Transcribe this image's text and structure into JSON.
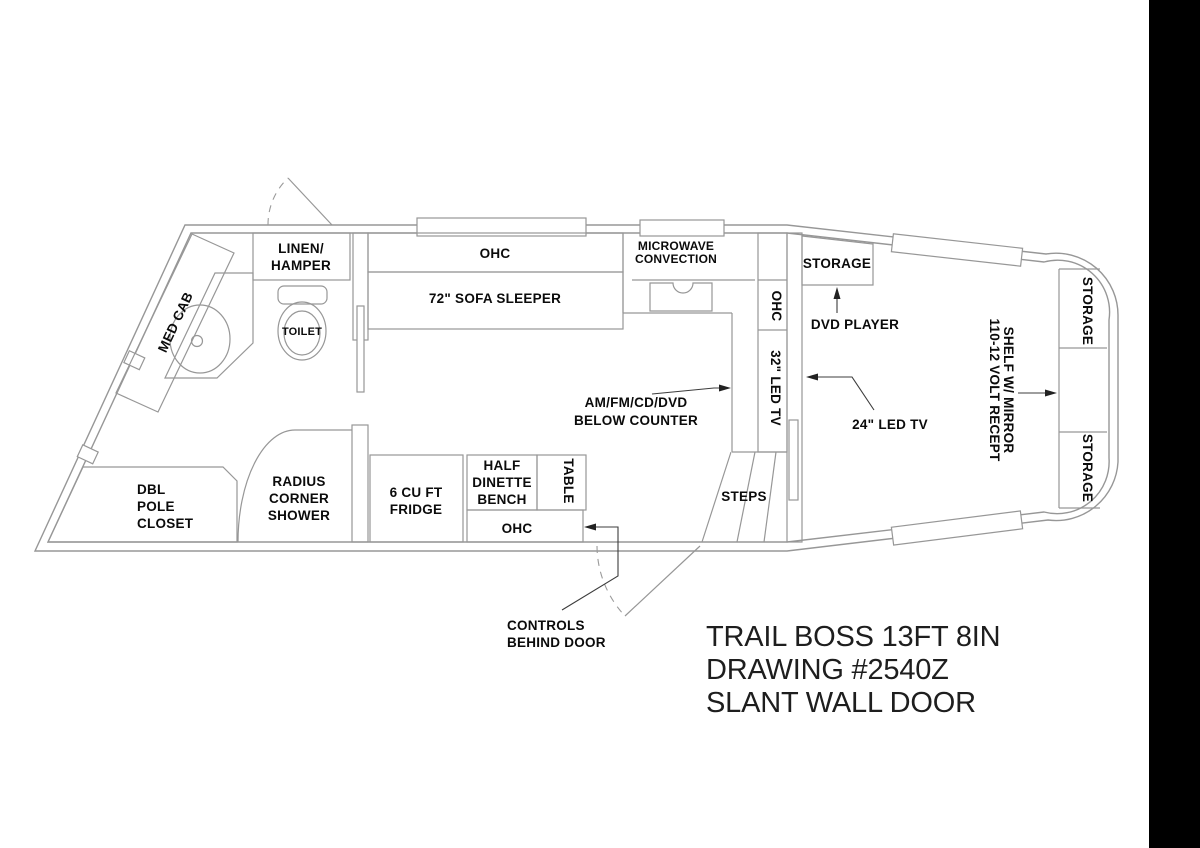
{
  "drawing": {
    "title_lines": [
      "TRAIL BOSS 13FT 8IN",
      "DRAWING #2540Z",
      "SLANT WALL DOOR"
    ],
    "colors": {
      "line": "#979797",
      "text": "#0b0b0b",
      "leader": "#3c3c3c",
      "background": "#ffffff",
      "edge_bar": "#000000"
    },
    "rooms": {
      "med_cab": "MED CAB",
      "linen_line1": "LINEN/",
      "linen_line2": "HAMPER",
      "toilet": "TOILET",
      "sofa_ohc": "OHC",
      "sofa": "72\" SOFA SLEEPER",
      "microwave_line1": "MICROWAVE",
      "microwave_line2": "CONVECTION",
      "storage_galley": "STORAGE",
      "dvd": "DVD PLAYER",
      "wall_ohc": "OHC",
      "tv32": "32\" LED TV",
      "radio_line1": "AM/FM/CD/DVD",
      "radio_line2": "BELOW COUNTER",
      "tv24": "24\" LED TV",
      "shelf_line1": "SHELF W/ MIRROR",
      "shelf_line2": "110-12 VOLT RECEPT",
      "storage_rear_top": "STORAGE",
      "storage_rear_bottom": "STORAGE",
      "closet_line1": "DBL",
      "closet_line2": "POLE",
      "closet_line3": "CLOSET",
      "shower_line1": "RADIUS",
      "shower_line2": "CORNER",
      "shower_line3": "SHOWER",
      "fridge_line1": "6 CU FT",
      "fridge_line2": "FRIDGE",
      "dinette_line1": "HALF",
      "dinette_line2": "DINETTE",
      "dinette_line3": "BENCH",
      "table": "TABLE",
      "dinette_ohc": "OHC",
      "steps": "STEPS",
      "controls_line1": "CONTROLS",
      "controls_line2": "BEHIND DOOR"
    }
  }
}
